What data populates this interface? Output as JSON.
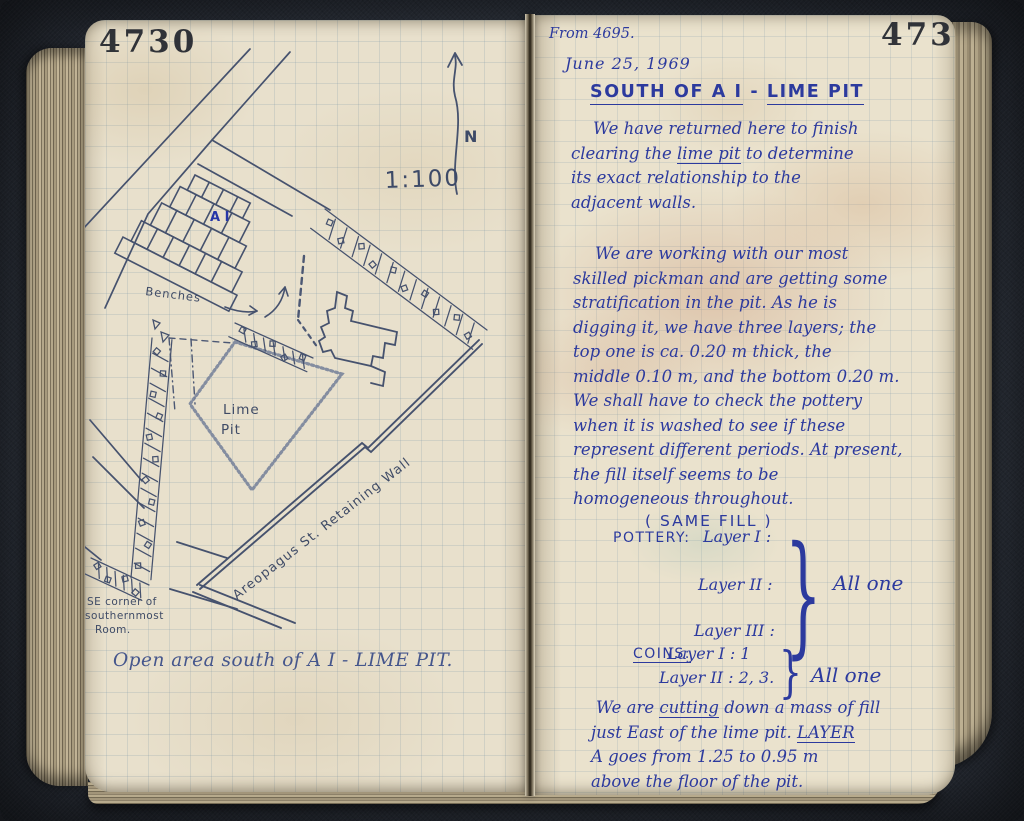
{
  "book": {
    "left_page": {
      "page_number": "4730",
      "scale_label": "1:100",
      "north_label": "N",
      "plan": {
        "structure_label": "A I",
        "benches_label": "Benches",
        "lime_pit_line1": "Lime",
        "lime_pit_line2": "Pit",
        "retaining_wall_label": "Areopagus St. Retaining Wall",
        "se_corner_line1": "SE corner of",
        "se_corner_line2": "southernmost",
        "se_corner_line3": "Room."
      },
      "caption": "Open area south of A I - LIME PIT."
    },
    "right_page": {
      "page_number": "4731",
      "from_reference": "From 4695.",
      "date": "June 25, 1969",
      "title_lines": [
        [
          {
            "t": "SOUTH OF A I",
            "u": true
          },
          {
            "t": "  -  ",
            "u": false
          },
          {
            "t": "LIME PIT",
            "u": true
          }
        ]
      ],
      "paragraph1": [
        [
          {
            "t": "We have returned here to finish",
            "u": false
          }
        ],
        [
          {
            "t": "clearing the ",
            "u": false
          },
          {
            "t": "lime pit",
            "u": true
          },
          {
            "t": " to determine",
            "u": false
          }
        ],
        [
          {
            "t": "its exact relationship to the",
            "u": false
          }
        ],
        [
          {
            "t": "adjacent walls.",
            "u": false
          }
        ]
      ],
      "paragraph2": [
        [
          {
            "t": "We are working with our most",
            "u": false
          }
        ],
        [
          {
            "t": "skilled pickman and are getting some",
            "u": false
          }
        ],
        [
          {
            "t": "stratification in the pit. As he is",
            "u": false
          }
        ],
        [
          {
            "t": "digging it, we have three layers; the",
            "u": false
          }
        ],
        [
          {
            "t": "top one is ca. 0.20 m thick, the",
            "u": false
          }
        ],
        [
          {
            "t": "middle 0.10 m, and the bottom 0.20 m.",
            "u": false
          }
        ],
        [
          {
            "t": "We shall have to check the pottery",
            "u": false
          }
        ],
        [
          {
            "t": "when it is washed to see if these",
            "u": false
          }
        ],
        [
          {
            "t": "represent different periods. At present,",
            "u": false
          }
        ],
        [
          {
            "t": "the fill itself seems to be",
            "u": false
          }
        ],
        [
          {
            "t": "homogeneous throughout.",
            "u": false
          }
        ]
      ],
      "same_fill_note": "( SAME FILL )",
      "pottery": {
        "label": "POTTERY:",
        "rows": [
          "Layer I :",
          "Layer II :",
          "Layer III :"
        ],
        "brace": "}",
        "note": "All one"
      },
      "coins": {
        "label_lines": [
          [
            {
              "t": "COINS:",
              "u": true
            }
          ]
        ],
        "rows": [
          "Layer I : 1",
          "Layer II : 2, 3."
        ],
        "brace": "}",
        "note": "All one"
      },
      "paragraph3": [
        [
          {
            "t": "We are ",
            "u": false
          },
          {
            "t": "cutting",
            "u": true
          },
          {
            "t": " down a mass of fill",
            "u": false
          }
        ],
        [
          {
            "t": "just East of the lime pit. ",
            "u": false
          },
          {
            "t": "LAYER",
            "u": true
          }
        ],
        [
          {
            "t": "A goes from 1.25 to 0.95 m",
            "u": false
          }
        ],
        [
          {
            "t": "above the floor of the pit.",
            "u": false
          }
        ]
      ]
    }
  }
}
